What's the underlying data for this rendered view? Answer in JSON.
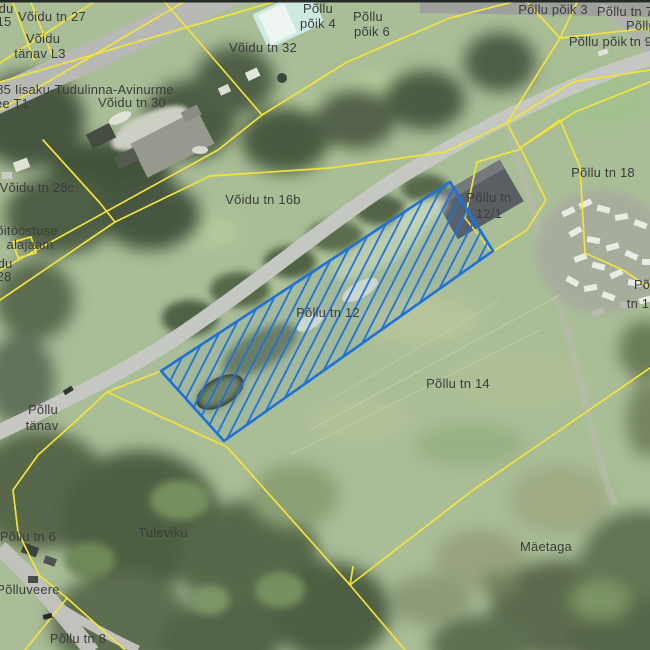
{
  "map": {
    "kind": "cadastral-aerial-map",
    "cadastral_line_color": "#f2e33c",
    "selected_parcel": {
      "label": "Põllu tn 12",
      "outline_color": "#1d72d8",
      "style": "blue-diagonal-hatch"
    },
    "labels": [
      {
        "text": "du",
        "x": 6,
        "y": 9
      },
      {
        "text": "15",
        "x": 4,
        "y": 22
      },
      {
        "text": "Võidu tn 27",
        "x": 52,
        "y": 17
      },
      {
        "text": "Võidu",
        "x": 43,
        "y": 39
      },
      {
        "text": "tänav L3",
        "x": 40,
        "y": 54
      },
      {
        "text": "85 Iisaku-Tudulinna-Avinurme",
        "x": 85,
        "y": 90
      },
      {
        "text": "ee T1",
        "x": 12,
        "y": 104
      },
      {
        "text": "Võidu tn 30",
        "x": 132,
        "y": 103
      },
      {
        "text": "Võidu tn 28c",
        "x": 37,
        "y": 188
      },
      {
        "text": "õitööstuse",
        "x": 27,
        "y": 231
      },
      {
        "text": "alajaam",
        "x": 30,
        "y": 245
      },
      {
        "text": "du",
        "x": 5,
        "y": 264
      },
      {
        "text": "28",
        "x": 4,
        "y": 277
      },
      {
        "text": "Võidu tn 32",
        "x": 263,
        "y": 48
      },
      {
        "text": "Põllu",
        "x": 318,
        "y": 9
      },
      {
        "text": "põik 4",
        "x": 318,
        "y": 24
      },
      {
        "text": "Põllu",
        "x": 368,
        "y": 17
      },
      {
        "text": "põik 6",
        "x": 372,
        "y": 32
      },
      {
        "text": "Põllu põik 3",
        "x": 553,
        "y": 10
      },
      {
        "text": "Põllu tn 7",
        "x": 625,
        "y": 12
      },
      {
        "text": "Põllu",
        "x": 641,
        "y": 26
      },
      {
        "text": "Põllu põik",
        "x": 598,
        "y": 42
      },
      {
        "text": "tn 9",
        "x": 641,
        "y": 42
      },
      {
        "text": "Võidu tn 16b",
        "x": 263,
        "y": 200
      },
      {
        "text": "Põllu tn",
        "x": 489,
        "y": 198
      },
      {
        "text": "12/1",
        "x": 489,
        "y": 214
      },
      {
        "text": "Põllu tn 18",
        "x": 603,
        "y": 173
      },
      {
        "text": "Põllu tn 12",
        "x": 328,
        "y": 313
      },
      {
        "text": "Põllu tn 14",
        "x": 458,
        "y": 384
      },
      {
        "text": "Põ",
        "x": 642,
        "y": 285
      },
      {
        "text": "tn 1",
        "x": 638,
        "y": 304
      },
      {
        "text": "Põllu",
        "x": 43,
        "y": 410
      },
      {
        "text": "tänav",
        "x": 42,
        "y": 426
      },
      {
        "text": "Põllu tn 6",
        "x": 28,
        "y": 537
      },
      {
        "text": "Tuleviku",
        "x": 163,
        "y": 533
      },
      {
        "text": "Põlluveere",
        "x": 28,
        "y": 590
      },
      {
        "text": "Põllu tn 8",
        "x": 78,
        "y": 639
      },
      {
        "text": "Mäetaga",
        "x": 546,
        "y": 547
      }
    ]
  }
}
